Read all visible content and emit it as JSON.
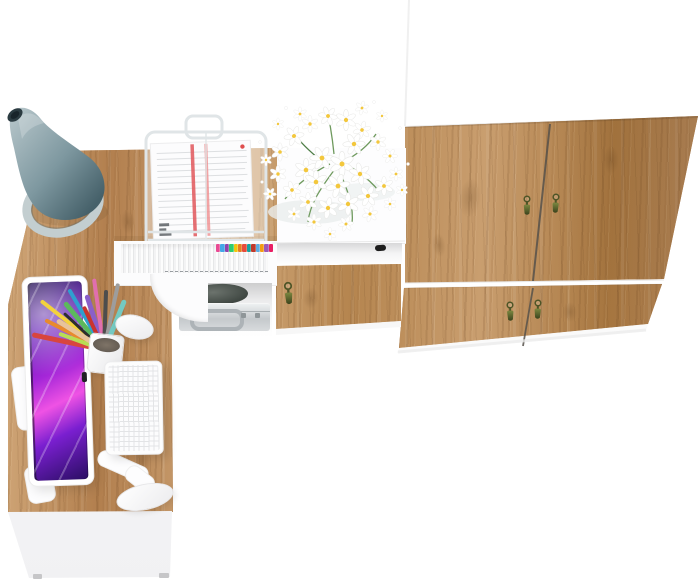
{
  "meta": {
    "title": "Office furniture set - top view product render",
    "description": "Bird's-eye 3D product render on a white background: golden-oak corner desk with white front panel holding an all-in-one computer with purple wallpaper, white keyboard and mouse, grey cone desk lamp, white pen cup with colored pens, and a white wire document tray with papers; hutch shelf filled with white files with colored index tabs above a compartment with a dark pouch and a silver briefcase; white low cabinet topped with a white daisy bouquet, an open niche with black knob and an oak drawer front with tassel key; tall wardrobe with white carcass and four oak doors fitted with olive tassel keys.",
    "background": "#ffffff"
  },
  "colors": {
    "bg": "#ffffff",
    "wood": "#c29467",
    "wood_light": "#d4ac7e",
    "wood_dark": "#8a5f33",
    "white_panel": "#fcfcfd",
    "lamp_light": "#b9c8cc",
    "lamp_mid": "#7e98a0",
    "lamp_deep": "#46616a",
    "lamp_tip": "#2b3b41",
    "screen_deep": "#1d0a4e",
    "screen_violet": "#a426d8",
    "screen_magenta": "#ef52e4",
    "key_olive": "#4e5527",
    "key_olive_light": "#7c8840",
    "key_olive_dark": "#3a421c",
    "red_stripe": "#e0565a",
    "knob_black": "#1d1d1d",
    "metal": "#c5c9cc",
    "seam": "#57524b"
  },
  "objects": {
    "scene": "Top view of a white and oak office furniture set",
    "desk_top": "oak corner desk top",
    "desk_front": "white desk front panel with feet",
    "hutch_fascia": "hutch shelf fascia",
    "file_folders": "row of white file folders on hutch shelf",
    "file_tabs": "colored index tabs on files",
    "side_panel": "curved white hutch side panel",
    "compartment": "open under-shelf compartment",
    "pouch": "dark fabric pouch",
    "briefcase": "silver briefcase",
    "briefcase_handle": "briefcase handle",
    "lamp": "grey cone desk lamp with oval base",
    "document_tray": "white wire document tray",
    "tray_papers": "stacked papers with red stripes",
    "pen_cup": "white pen cup",
    "pens": "colored pens and pencils",
    "monitor": "white all-in-one computer",
    "monitor_screen": "purple galaxy wallpaper screen",
    "monitor_stand": "white monitor stand and foot",
    "keyboard": "white wireless keyboard",
    "mouse": "white wireless mouse",
    "flowers": "white daisy bouquet",
    "cabinet_top": "white low cabinet top",
    "cabinet_niche": "open cabinet niche",
    "cabinet_knob": "black niche knob",
    "cabinet_front": "oak cabinet drawer front",
    "wardrobe_upper_doors": "wardrobe upper oak doors",
    "wardrobe_lower_doors": "wardrobe lower oak doors",
    "wardrobe_bottom": "wardrobe bottom edge",
    "door_key": "olive tassel key in keyhole",
    "door_seam": "gap between wardrobe doors"
  },
  "files": {
    "tab_colors": [
      "#e84a93",
      "#45a7e8",
      "#8e44ad",
      "#2ecc71",
      "#f1c40f",
      "#e67e22",
      "#e74c3c",
      "#17a2a0",
      "#c0392b",
      "#5dade2",
      "#f39c12",
      "#9b59b6",
      "#e91e63"
    ]
  },
  "pens": [
    {
      "color": "#d8453f",
      "angle": -78,
      "length": 74,
      "width": 5
    },
    {
      "color": "#e88a2e",
      "angle": -63,
      "length": 66,
      "width": 4
    },
    {
      "color": "#f3d23c",
      "angle": -52,
      "length": 80,
      "width": 4
    },
    {
      "color": "#5cb85c",
      "angle": -40,
      "length": 62,
      "width": 5
    },
    {
      "color": "#2f9fd0",
      "angle": -30,
      "length": 70,
      "width": 4
    },
    {
      "color": "#8a5fc9",
      "angle": -18,
      "length": 58,
      "width": 5
    },
    {
      "color": "#e06fae",
      "angle": -8,
      "length": 72,
      "width": 4
    },
    {
      "color": "#4d4d4d",
      "angle": 2,
      "length": 60,
      "width": 4
    },
    {
      "color": "#9d9d9d",
      "angle": 12,
      "length": 68,
      "width": 4
    },
    {
      "color": "#74c9c1",
      "angle": 22,
      "length": 54,
      "width": 5
    },
    {
      "color": "#b8dd55",
      "angle": -70,
      "length": 48,
      "width": 4
    },
    {
      "color": "#c9342e",
      "angle": -25,
      "length": 48,
      "width": 4
    },
    {
      "color": "#2e2e2e",
      "angle": -47,
      "length": 54,
      "width": 3
    },
    {
      "color": "#e8c49a",
      "angle": -58,
      "length": 56,
      "width": 5
    }
  ]
}
